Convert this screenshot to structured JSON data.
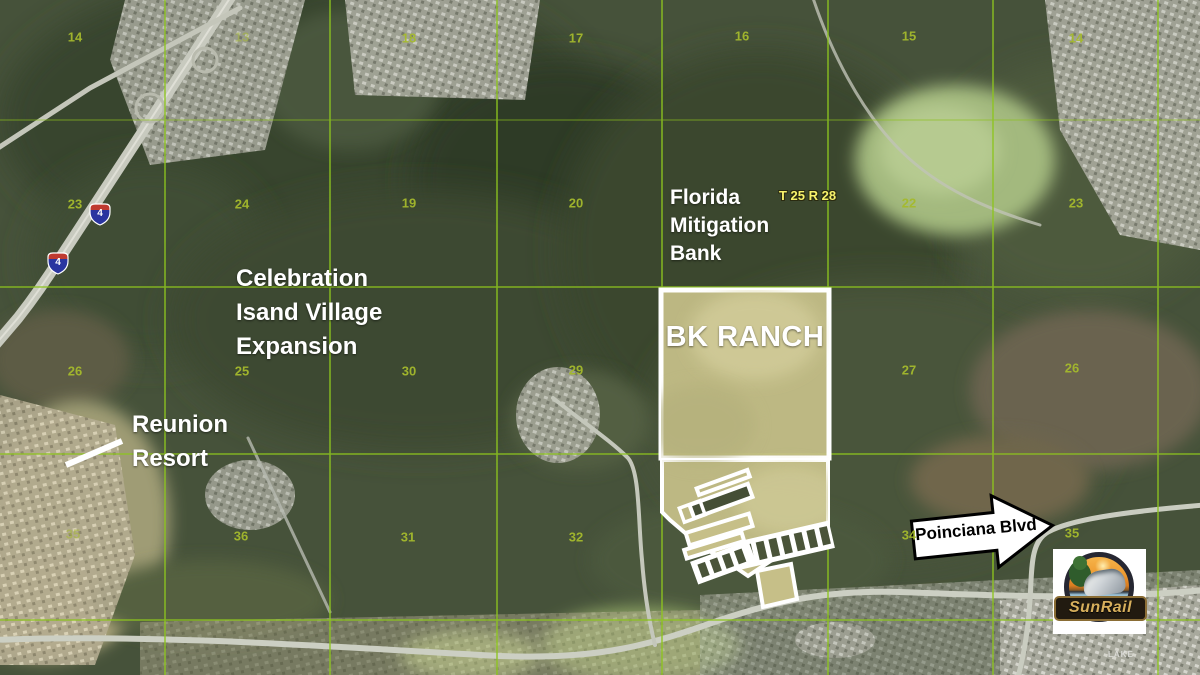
{
  "annotations": {
    "bk_ranch": "BK RANCH",
    "mitigation": [
      "Florida",
      "Mitigation",
      "Bank"
    ],
    "township_range": "T 25 R 28",
    "celebration": [
      "Celebration",
      "Isand Village",
      "Expansion"
    ],
    "reunion": [
      "Reunion",
      "Resort"
    ],
    "poinciana": "Poinciana Blvd",
    "lake_label": "LAKE",
    "interstate_number": "4"
  },
  "logo": {
    "text": "SunRail"
  },
  "sections": [
    {
      "n": "14",
      "x": 75,
      "y": 37
    },
    {
      "n": "13",
      "x": 242,
      "y": 37,
      "faint": true
    },
    {
      "n": "18",
      "x": 409,
      "y": 38
    },
    {
      "n": "17",
      "x": 576,
      "y": 38
    },
    {
      "n": "16",
      "x": 742,
      "y": 36
    },
    {
      "n": "15",
      "x": 909,
      "y": 36
    },
    {
      "n": "14",
      "x": 1076,
      "y": 38
    },
    {
      "n": "23",
      "x": 75,
      "y": 204
    },
    {
      "n": "24",
      "x": 242,
      "y": 204
    },
    {
      "n": "19",
      "x": 409,
      "y": 203
    },
    {
      "n": "20",
      "x": 576,
      "y": 203
    },
    {
      "n": "22",
      "x": 909,
      "y": 203
    },
    {
      "n": "23",
      "x": 1076,
      "y": 203
    },
    {
      "n": "26",
      "x": 75,
      "y": 371
    },
    {
      "n": "25",
      "x": 242,
      "y": 371
    },
    {
      "n": "30",
      "x": 409,
      "y": 371
    },
    {
      "n": "29",
      "x": 576,
      "y": 370
    },
    {
      "n": "27",
      "x": 909,
      "y": 370
    },
    {
      "n": "26",
      "x": 1072,
      "y": 368
    },
    {
      "n": "35",
      "x": 73,
      "y": 534,
      "faint": true
    },
    {
      "n": "36",
      "x": 241,
      "y": 536
    },
    {
      "n": "31",
      "x": 408,
      "y": 537
    },
    {
      "n": "32",
      "x": 576,
      "y": 537
    },
    {
      "n": "34",
      "x": 909,
      "y": 535
    },
    {
      "n": "35",
      "x": 1072,
      "y": 533
    }
  ],
  "colors": {
    "grid_line": "#8dc41f",
    "section_number": "#a5ba2d",
    "township_label": "#f7f26b",
    "ranch_fill": "#c8c18a",
    "ranch_border": "#ffffff",
    "label_text": "#ffffff",
    "arrow_fill": "#ffffff",
    "arrow_outline": "#000000",
    "shield_blue": "#2a35a0",
    "shield_red": "#bf3a30",
    "sunrail_gold": "#d7af5c"
  }
}
